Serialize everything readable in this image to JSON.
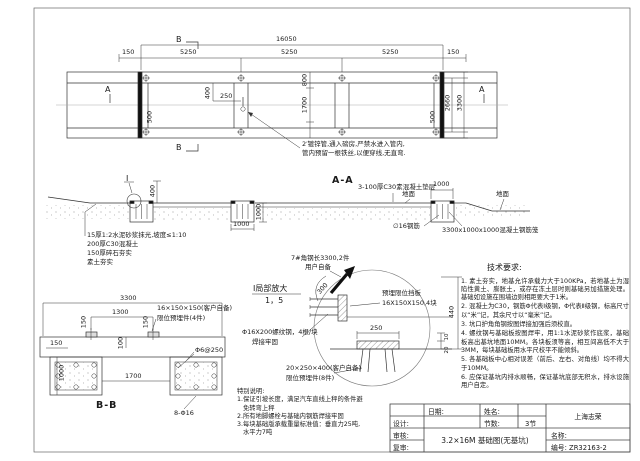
{
  "plan": {
    "dim_total": "16050",
    "dim_seg": "5250",
    "dim_end": "150",
    "dim_400": "400",
    "dim_250": "250",
    "dim_800": "800",
    "dim_1700": "1700",
    "dim_500": "500",
    "dim_inner_width": "2660",
    "dim_outer_width": "3300",
    "marker_a": "A",
    "marker_b": "B",
    "pipe_note_line1": "2′镀锌管,通入磅房,严禁水进入管内,",
    "pipe_note_line2": "管内预留一根铁丝,以便穿线,无直弯."
  },
  "section_aa": {
    "title": "A-A",
    "cushion_note": "3-100厚C30素混凝土垫层",
    "ground_label": "地面",
    "dim_1000": "1000",
    "dim_400": "400",
    "rebar_note": "∅16钢筋",
    "cage_note": "3300x1000x1000混凝土钢筋笼",
    "detail_marker": "Ⅰ",
    "layer_note_1": "15厚1:2水泥砂浆抹光,坡度≤1:10",
    "layer_note_2": "200厚C30混凝土",
    "layer_note_3": "150厚碎石夯实",
    "layer_note_4": "素土夯实"
  },
  "detail_i": {
    "angle_note_line1": "7#角钢长3300,2件",
    "angle_note_line2": "用户自备",
    "dim_300": "300",
    "stop_plate_line1": "预埋限位挡板",
    "stop_plate_line2": "16X150X150,4块",
    "title_line1": "Ⅰ局部放大",
    "title_line2": "1，5",
    "bolt_note_line1": "Φ16X200螺纹钢，4根/块",
    "bolt_note_line2": "焊接牢固",
    "embed_note_line1": "20×250×400(客户自备)",
    "embed_note_line2": "限位预埋件(8件)",
    "dim_250": "250",
    "dim_440": "440",
    "dim_10": "10",
    "dim_20": "20"
  },
  "section_bb": {
    "title": "B-B",
    "dim_3300": "3300",
    "dim_1300": "1300",
    "dim_150": "150",
    "dim_100": "100",
    "dim_1000": "1000",
    "dim_1700": "1700",
    "plate_note_line1": "16×150×150(客户自备)",
    "plate_note_line2": "限位预埋件(4件)",
    "stirrup_note": "Φ6@250",
    "bar_note": "8-Φ16"
  },
  "special_notes": {
    "title": "特别说明:",
    "line1": "1.保证引坡长度，满足汽车直线上秤的条件避",
    "line2": "免转弯上秤",
    "line3": "2.所有地脚螺栓与基础内钢筋焊接牢固",
    "line4": "3.每块基础版承载重量标准值：垂直力25吨,",
    "line5": "水平力7吨"
  },
  "tech_requirements": {
    "title": "技术要求:",
    "items": [
      "1. 素土夯实，地基允许承载力大于100KPa，若地基土为湿陷性黄土、膨胀土，或存在冻土层时则基础另加措施处理。基础如设施在围墙边则相距要大于1米。",
      "2. 混凝土为C30，钢筋Φ代表Ⅰ级钢，Φ代表Ⅱ级钢，标高尺寸以“米”记，其余尺寸以“毫米”记。",
      "3. 坑口护角角钢按图焊接加强后须校直。",
      "4. 螺纹钢与基础板按图焊牢，用1:1水泥砂浆作底浆，基础板高出基坑地面10MM。各块板须等高，相互间高低不大于3MM，每块基础板用水平尺校平不能倾斜。",
      "5. 各基础板中心相对误差（前后、左右、对角线）均不得大于10MM。",
      "6. 应保证基坑内排水顺畅，保证基坑底部无积水，排水设施用户自定。"
    ]
  },
  "title_block": {
    "date_label": "日期:",
    "name_label": "姓名:",
    "sections_label": "节数:",
    "sections_value": "3节",
    "design_label": "设计:",
    "review_label": "审核:",
    "recheck_label": "复审:",
    "drawing_title": "3.2×16M 基础图(无基坑)",
    "company": "上海志荣",
    "title_label": "名称:",
    "number_label": "编号: ZR32163-2"
  }
}
